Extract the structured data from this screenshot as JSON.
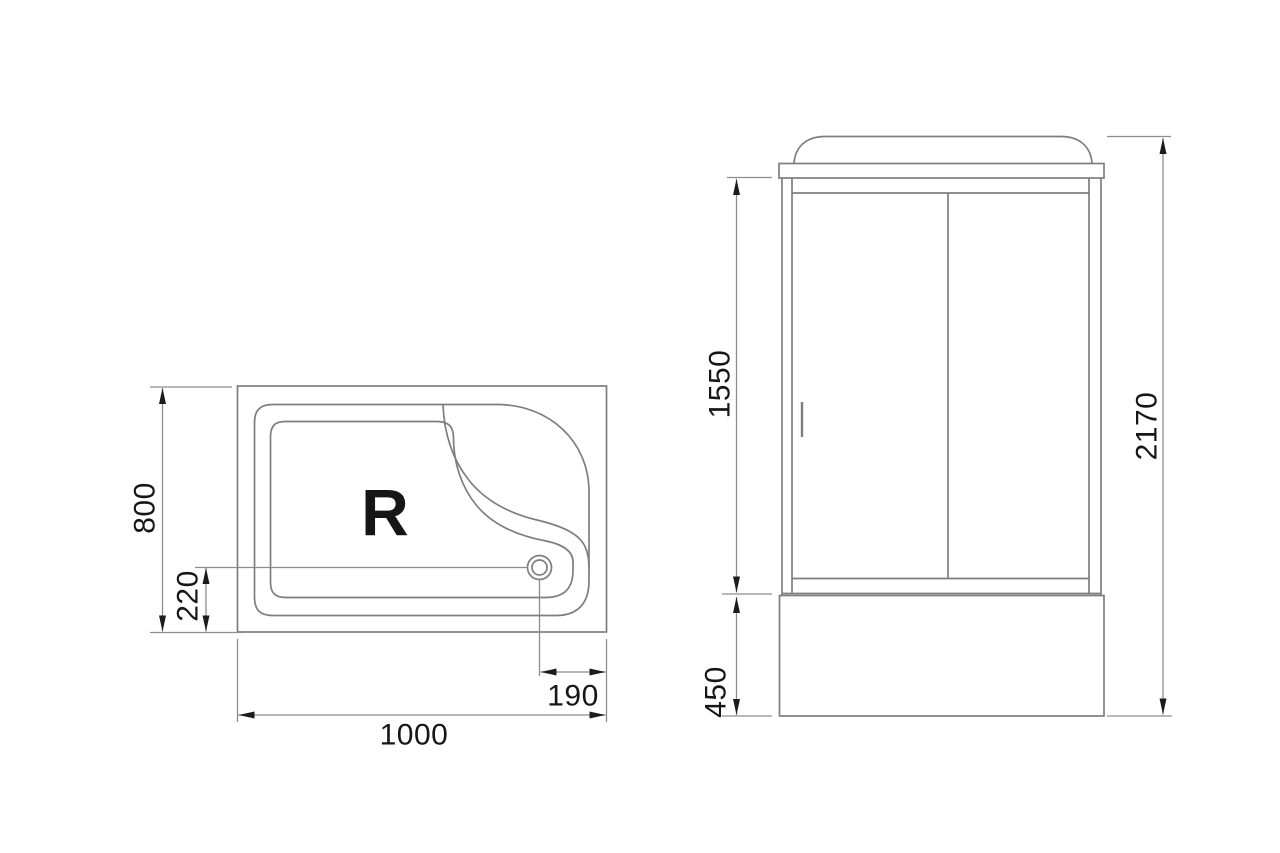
{
  "drawing": {
    "colors": {
      "background": "#ffffff",
      "line": "#7e7e7e",
      "dim_line": "#8d8d8d",
      "text": "#161616",
      "arrow": "#1c1c1c"
    },
    "top_view": {
      "orientation_marker": "R",
      "dim_width": "1000",
      "dim_depth": "800",
      "dim_drain_offset_front": "220",
      "dim_drain_offset_side": "190"
    },
    "front_view": {
      "dim_door_height": "1550",
      "dim_base_height": "450",
      "dim_total_height": "2170"
    }
  }
}
